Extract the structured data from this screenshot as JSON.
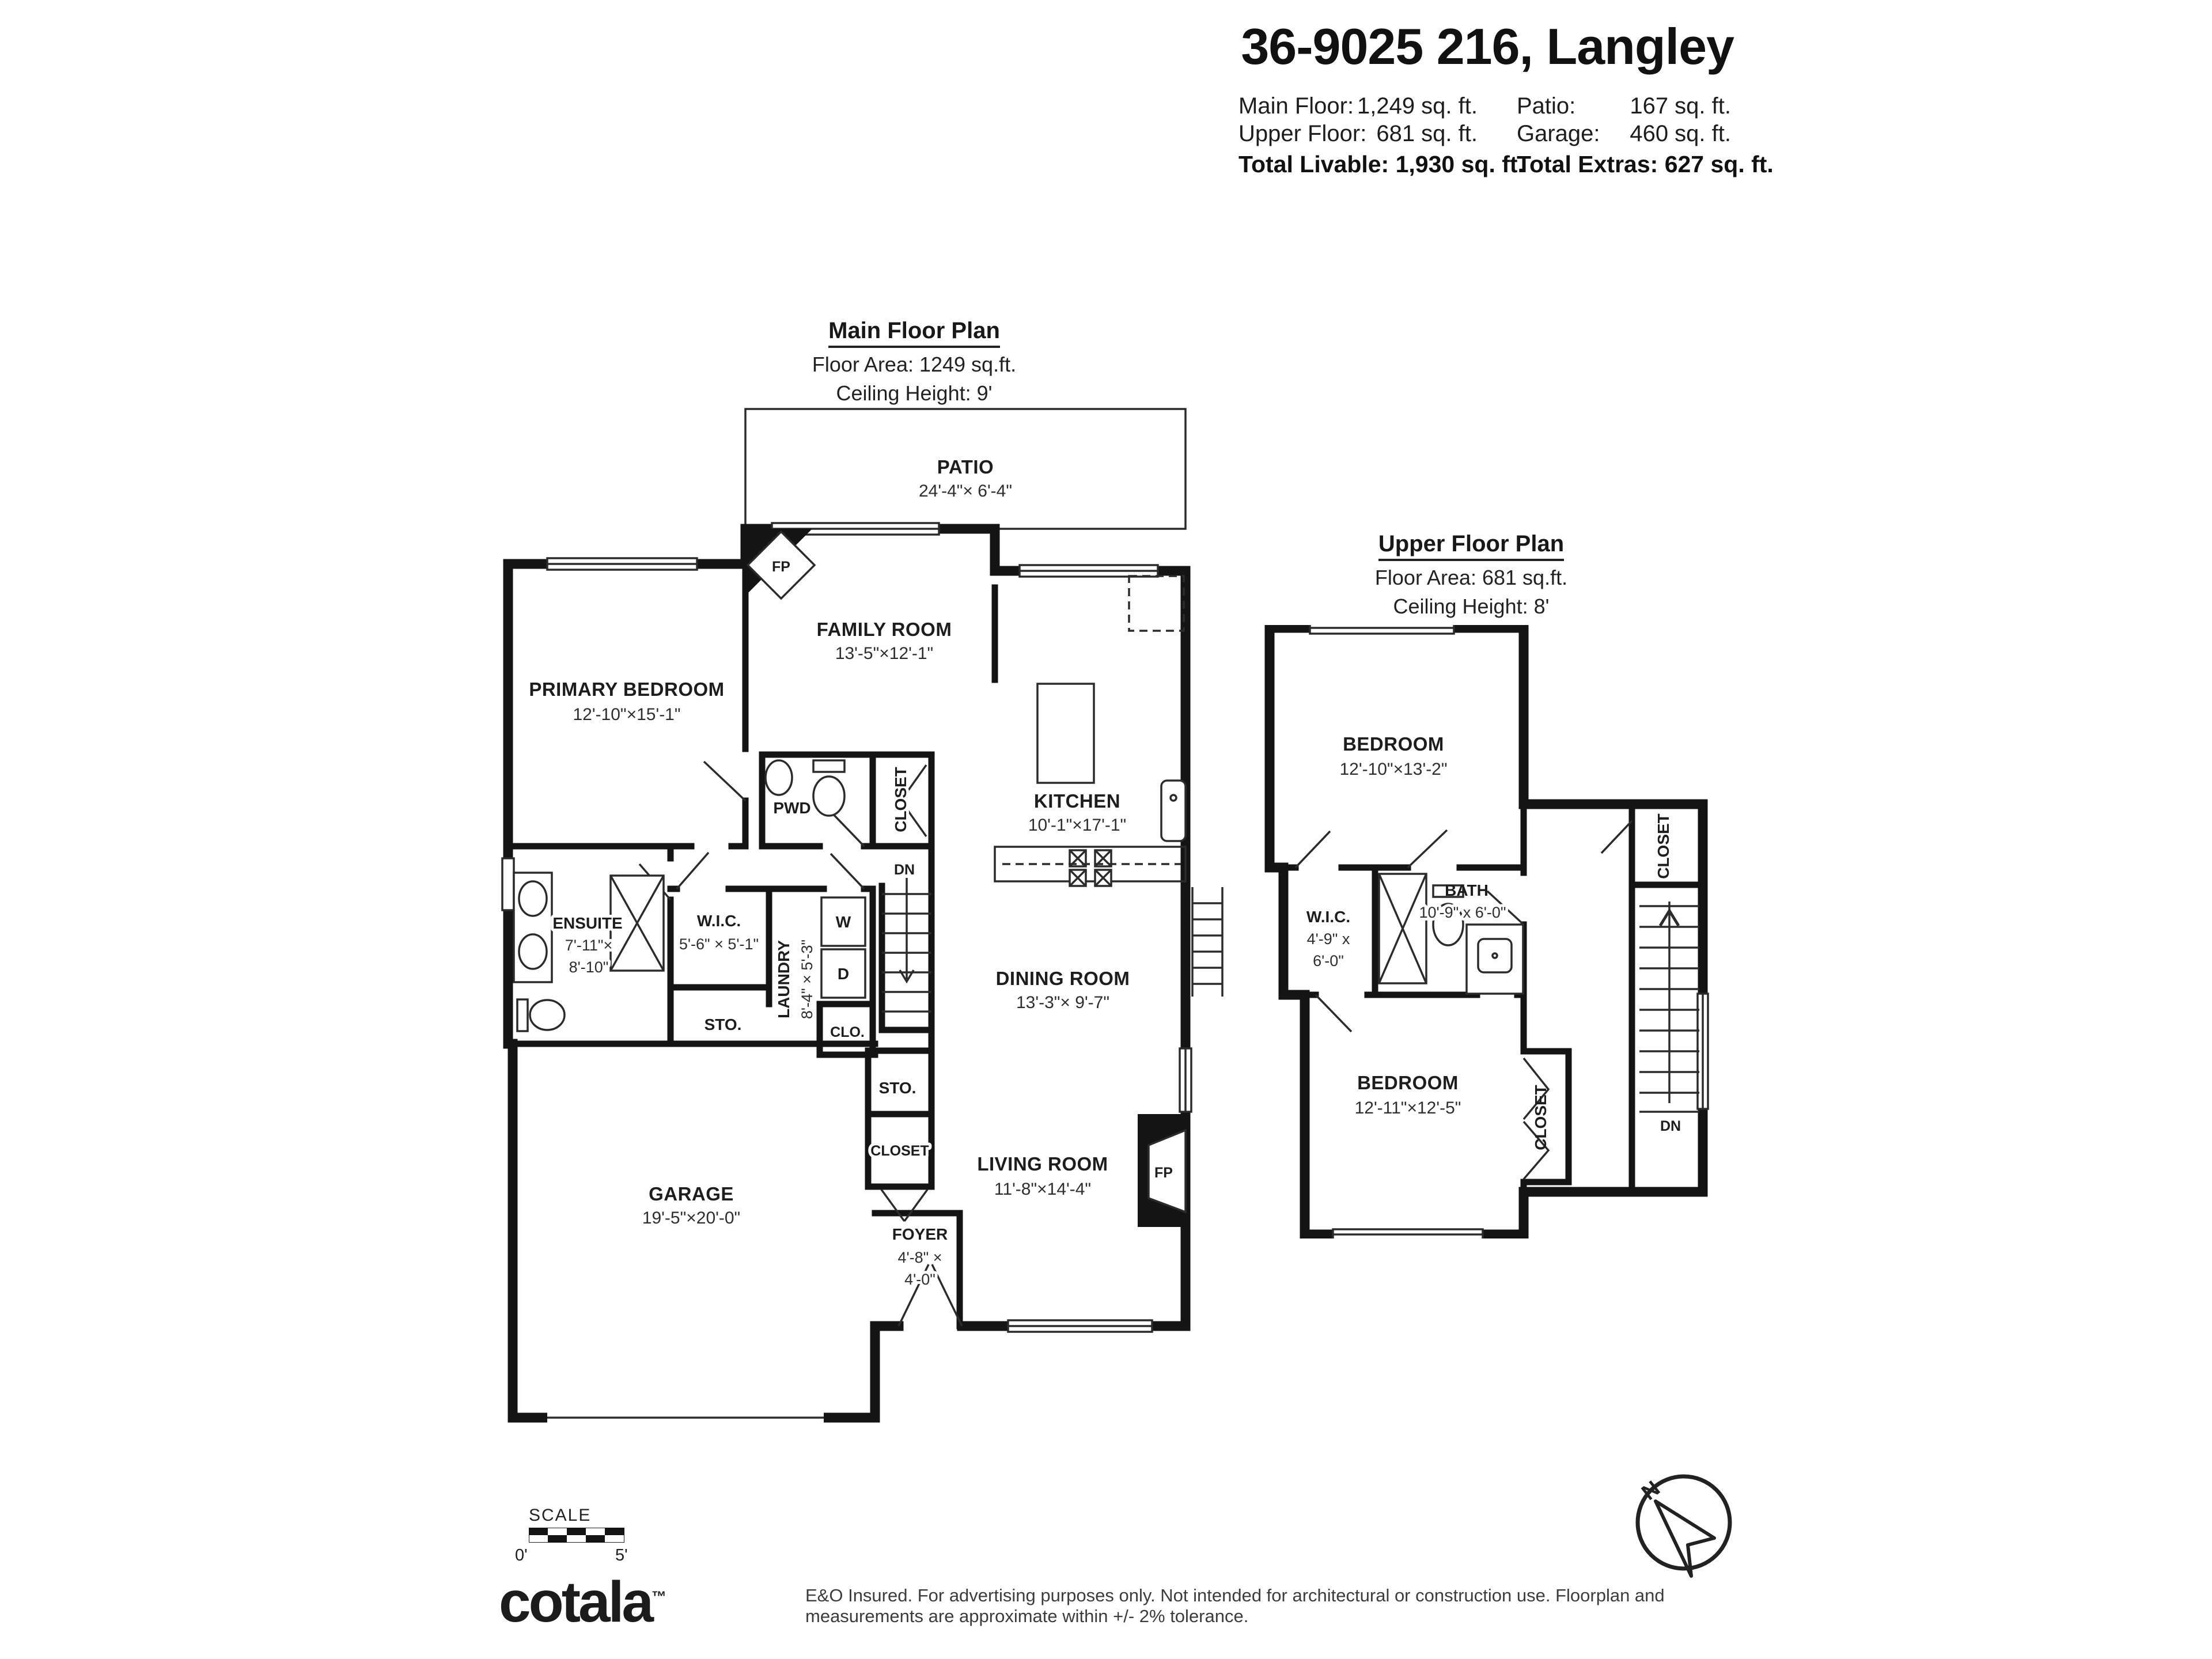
{
  "header": {
    "title": "36-9025 216, Langley",
    "main_floor_label": "Main Floor:",
    "main_floor_value": "1,249 sq. ft.",
    "upper_floor_label": "Upper Floor:",
    "upper_floor_value": "681 sq. ft.",
    "patio_label": "Patio:",
    "patio_value": "167 sq. ft.",
    "garage_label": "Garage:",
    "garage_value": "460 sq. ft.",
    "total_livable": "Total Livable: 1,930 sq. ft.",
    "total_extras": "Total Extras: 627 sq. ft."
  },
  "main_floor": {
    "title": "Main Floor Plan",
    "area": "Floor Area: 1249 sq.ft.",
    "ceiling": "Ceiling Height: 9'",
    "rooms": {
      "patio": {
        "name": "PATIO",
        "dims": "24'-4\"× 6'-4\""
      },
      "family_room": {
        "name": "FAMILY ROOM",
        "dims": "13'-5\"×12'-1\""
      },
      "primary_bedroom": {
        "name": "PRIMARY BEDROOM",
        "dims": "12'-10\"×15'-1\""
      },
      "kitchen": {
        "name": "KITCHEN",
        "dims": "10'-1\"×17'-1\""
      },
      "pwd": {
        "name": "PWD"
      },
      "hall_closet": {
        "name": "CLOSET"
      },
      "ensuite": {
        "name": "ENSUITE",
        "dims_line1": "7'-11\"×",
        "dims_line2": "8'-10\""
      },
      "wic": {
        "name": "W.I.C.",
        "dims": "5'-6\" × 5'-1\""
      },
      "laundry": {
        "name": "LAUNDRY",
        "dims": "8'-4\" × 5'-3\""
      },
      "washer": "W",
      "dryer": "D",
      "storage1": {
        "name": "STO."
      },
      "clo": {
        "name": "CLO."
      },
      "storage2": {
        "name": "STO."
      },
      "stairs_dn": "DN",
      "dining_room": {
        "name": "DINING ROOM",
        "dims": "13'-3\"× 9'-7\""
      },
      "living_room": {
        "name": "LIVING ROOM",
        "dims": "11'-8\"×14'-4\""
      },
      "fireplace": "FP",
      "foyer_closet": {
        "name": "CLOSET"
      },
      "foyer": {
        "name": "FOYER",
        "dims_line1": "4'-8\" ×",
        "dims_line2": "4'-0\""
      },
      "garage": {
        "name": "GARAGE",
        "dims": "19'-5\"×20'-0\""
      }
    }
  },
  "upper_floor": {
    "title": "Upper Floor Plan",
    "area": "Floor Area: 681 sq.ft.",
    "ceiling": "Ceiling Height: 8'",
    "rooms": {
      "bedroom_top": {
        "name": "BEDROOM",
        "dims": "12'-10\"×13'-2\""
      },
      "closet_top": {
        "name": "CLOSET"
      },
      "wic": {
        "name": "W.I.C.",
        "dims_line1": "4'-9\" x",
        "dims_line2": "6'-0\""
      },
      "bath": {
        "name": "BATH",
        "dims": "10'-9\" x 6'-0\""
      },
      "bedroom_bottom": {
        "name": "BEDROOM",
        "dims": "12'-11\"×12'-5\""
      },
      "closet_bottom": {
        "name": "CLOSET"
      },
      "stairs_dn": "DN"
    }
  },
  "footer": {
    "scale_label": "SCALE",
    "scale_start": "0'",
    "scale_end": "5'",
    "brand": "cotala",
    "brand_mark": "™",
    "disclaimer": "E&O Insured. For advertising purposes only. Not intended for architectural or construction use. Floorplan and measurements are approximate within +/- 2% tolerance.",
    "north": "N"
  }
}
